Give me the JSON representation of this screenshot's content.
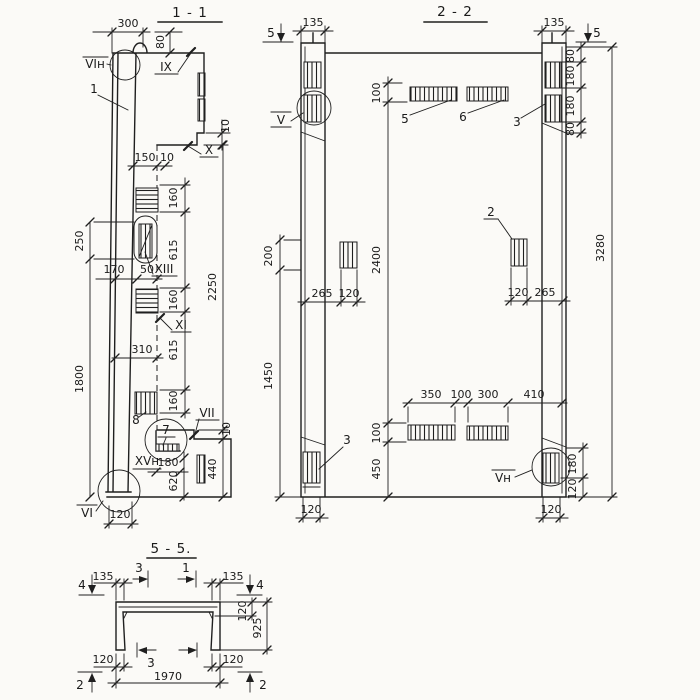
{
  "sections": [
    {
      "id": "1-1",
      "title": "1 - 1"
    },
    {
      "id": "2-2",
      "title": "2 - 2"
    },
    {
      "id": "5-5",
      "title": "5 - 5."
    }
  ],
  "dims": {
    "d10": "10",
    "d50": "50",
    "d80": "80",
    "d100": "100",
    "d120": "120",
    "d135": "135",
    "d150": "150",
    "d160": "160",
    "d170": "170",
    "d180": "180",
    "d200": "200",
    "d250": "250",
    "d265": "265",
    "d300": "300",
    "d310": "310",
    "d350": "350",
    "d410": "410",
    "d440": "440",
    "d450": "450",
    "d615": "615",
    "d620": "620",
    "d925": "925",
    "d1450": "1450",
    "d1800": "1800",
    "d1970": "1970",
    "d2250": "2250",
    "d2400": "2400",
    "d3280": "3280"
  },
  "marks": {
    "pos1": "1",
    "pos2": "2",
    "pos3": "3",
    "pos5": "5",
    "pos6": "6",
    "pos7": "7",
    "pos8": "8",
    "secV": "V",
    "secVn": "Vн",
    "secVI": "VI",
    "secVIn": "VIн",
    "secVII": "VII",
    "secIX": "IX",
    "secX": "X",
    "secXI": "XI",
    "secXIII": "XIII",
    "secXVn": "XVн",
    "cut1": "1",
    "cut2": "2",
    "cut3": "3",
    "cut4": "4",
    "cut5": "5"
  }
}
